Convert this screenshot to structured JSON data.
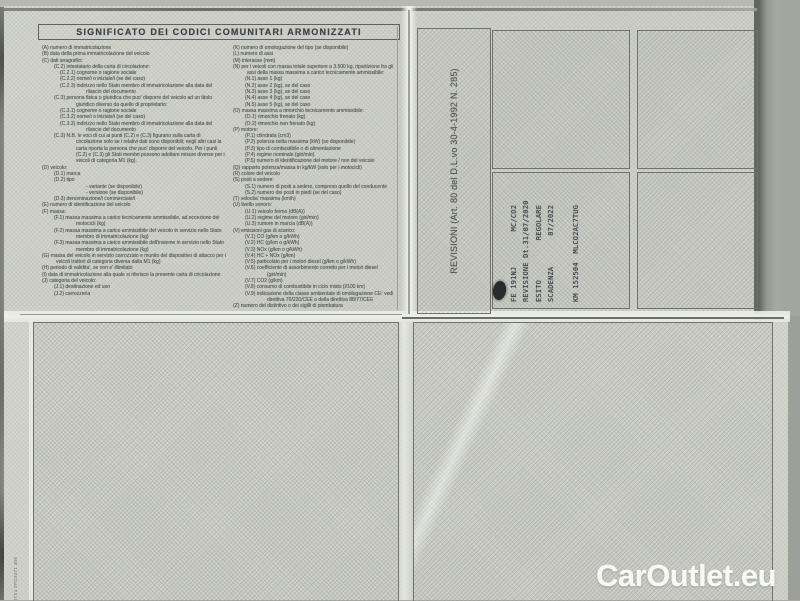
{
  "page": {
    "title": "SIGNIFICATO DEI CODICI COMUNITARI ARMONIZZATI",
    "side_serial": "ITIIu 3PO3471 408",
    "watermark": "CarOutlet.eu"
  },
  "colors": {
    "paper": "#d2d4cd",
    "hatch": "#aeb2a8",
    "legend_ink": "#565b57",
    "stamp_ink": "#3e4149",
    "watermark_text": "#fdfefd"
  },
  "codes": {
    "left_column": [
      {
        "l": 0,
        "t": "(A)  numero di immatricolazione"
      },
      {
        "l": 0,
        "t": "(B)  data della prima immatricolazione del veicolo"
      },
      {
        "l": 0,
        "t": "(C)  dati anagrafici:"
      },
      {
        "l": 1,
        "t": "(C.2)  intestatario della carta di circolazione:"
      },
      {
        "l": 2,
        "t": "(C.2.1)  cognome o ragione sociale"
      },
      {
        "l": 2,
        "t": "(C.2.2)  nome/i o iniziale/i (se del caso)"
      },
      {
        "l": 2,
        "t": "(C.2.3)  indirizzo nello Stato membro di immatricolazione alla data del rilascio del documento"
      },
      {
        "l": 1,
        "t": "(C.3)  persona fisica o giuridica che puo' disporre del veicolo ad un titolo giuridico diverso da quello di proprietario:"
      },
      {
        "l": 2,
        "t": "(C.3.1)  cognome o ragione sociale"
      },
      {
        "l": 2,
        "t": "(C.3.2)  nome/i o iniziale/i (se del caso)"
      },
      {
        "l": 2,
        "t": "(C.3.3)  indirizzo nello Stato membro di immatricolazione alla data del rilascio del documento"
      },
      {
        "l": 1,
        "t": "(C.3)  N.B. le voci di cui ai punti (C.2) e (C.3) figurano sulla carta di circolazione solo se i relativi dati sono disponibili; negli altri casi la carta riporta la persona che puo' disporre del veicolo. Per i punti (C.2) e (C.3) gli Stati membri possono adottare misure diverse per i veicoli di categoria M1 (kg)."
      },
      {
        "l": 0,
        "t": "(D)  veicolo:"
      },
      {
        "l": 1,
        "t": "(D.1)  marca"
      },
      {
        "l": 1,
        "t": "(D.2)  tipo"
      },
      {
        "l": 3,
        "t": "-  variante (se disponibile)"
      },
      {
        "l": 3,
        "t": "-  versione (se disponibile)"
      },
      {
        "l": 1,
        "t": "(D.3)  denominazione/i commerciale/i"
      },
      {
        "l": 0,
        "t": "(E)  numero di identificazione del veicolo"
      },
      {
        "l": 0,
        "t": "(F)  massa:"
      },
      {
        "l": 1,
        "t": "(F.1)  massa massima a carico tecnicamente ammissibile, ad eccezione dei motocicli (kg)"
      },
      {
        "l": 1,
        "t": "(F.2)  massa massima a carico ammissibile del veicolo in servizio nello Stato membro di immatricolazione (kg)"
      },
      {
        "l": 1,
        "t": "(F.3)  massa massima a carico ammissibile dell'insieme in servizio nello Stato membro di immatricolazione (kg)"
      },
      {
        "l": 0,
        "t": "(G)  massa del veicolo in servizio carrozzato e munito del dispositivo di attacco per i veicoli trattori di categoria diversa dalla M1 (kg)"
      },
      {
        "l": 0,
        "t": "(H)  periodo di validita', se non e' illimitato"
      },
      {
        "l": 0,
        "t": "(I)  data di immatricolazione alla quale si riferisce la presente carta di circolazione"
      },
      {
        "l": 0,
        "t": "(J)  categoria del veicolo:"
      },
      {
        "l": 1,
        "t": "(J.1)  destinazione ed uso"
      },
      {
        "l": 1,
        "t": "(J.2)  carrozzeria"
      }
    ],
    "right_column": [
      {
        "l": 0,
        "t": "(K)  numero di omologazione del tipo (se disponibile)"
      },
      {
        "l": 0,
        "t": "(L)  numero di assi"
      },
      {
        "l": 0,
        "t": "(M)  interasse (mm)"
      },
      {
        "l": 0,
        "t": "(N)  per i veicoli con massa totale superiore a 3.500 kg, ripartizione fra gli assi della massa massima a carico tecnicamente ammissibile:"
      },
      {
        "l": 1,
        "t": "(N.1)  asse 1 (kg)"
      },
      {
        "l": 1,
        "t": "(N.2)  asse 2 (kg), se del caso"
      },
      {
        "l": 1,
        "t": "(N.3)  asse 3 (kg), se del caso"
      },
      {
        "l": 1,
        "t": "(N.4)  asse 4 (kg), se del caso"
      },
      {
        "l": 1,
        "t": "(N.5)  asse 5 (kg), se del caso"
      },
      {
        "l": 0,
        "t": "(O)  massa massima a rimorchio tecnicamente ammissibile:"
      },
      {
        "l": 1,
        "t": "(O.1)  rimorchio frenato (kg)"
      },
      {
        "l": 1,
        "t": "(O.2)  rimorchio non frenato (kg)"
      },
      {
        "l": 0,
        "t": "(P)  motore:"
      },
      {
        "l": 1,
        "t": "(P.1)  cilindrata (cm3)"
      },
      {
        "l": 1,
        "t": "(P.2)  potenza netta massima (kW) (se disponibile)"
      },
      {
        "l": 1,
        "t": "(P.3)  tipo di combustibile o di alimentazione"
      },
      {
        "l": 1,
        "t": "(P.4)  regime nominale (giri/min)"
      },
      {
        "l": 1,
        "t": "(P.5)  numero di identificazione del motore / non del veicolo"
      },
      {
        "l": 0,
        "t": "(Q)  rapporto potenza/massa in kg/kW (solo per i motocicli)"
      },
      {
        "l": 0,
        "t": "(R)  colore del veicolo"
      },
      {
        "l": 0,
        "t": "(S)  posti a sedere:"
      },
      {
        "l": 1,
        "t": "(S.1)  numero di posti a sedere, compreso quello del conducente"
      },
      {
        "l": 1,
        "t": "(S.2)  numero dei posti in piedi (se del caso)"
      },
      {
        "l": 0,
        "t": "(T)  velocita' massima (km/h)"
      },
      {
        "l": 0,
        "t": "(U)  livello sonoro:"
      },
      {
        "l": 1,
        "t": "(U.1)  veicolo fermo (dB(A))"
      },
      {
        "l": 1,
        "t": "(U.2)  regime del motore (giri/min)"
      },
      {
        "l": 1,
        "t": "(U.3)  rumore in marcia (dB(A))"
      },
      {
        "l": 0,
        "t": "(V)  emissioni gas di scarico:"
      },
      {
        "l": 1,
        "t": "(V.1)  CO (g/km o g/kWh)"
      },
      {
        "l": 1,
        "t": "(V.2)  HC (g/km o g/kWh)"
      },
      {
        "l": 1,
        "t": "(V.3)  NOx (g/km o g/kWh)"
      },
      {
        "l": 1,
        "t": "(V.4)  HC + NOx (g/km)"
      },
      {
        "l": 1,
        "t": "(V.5)  particolato per i motori diesel (g/km o g/kWh)"
      },
      {
        "l": 1,
        "t": "(V.6)  coefficiente di assorbimento corretto per i motori diesel (giri/min)"
      },
      {
        "l": 1,
        "t": "(V.7)  CO2 (g/km)"
      },
      {
        "l": 1,
        "t": "(V.8)  consumo di combustibile in ciclo misto (l/100 km)"
      },
      {
        "l": 1,
        "t": "(V.9)  indicazione della classe ambientale di omologazione CE: vedi direttiva 70/220/CEE o della direttiva 88/77/CEE"
      },
      {
        "l": 0,
        "t": "(Z)  numero del distintivo o dei sigilli di piombatura"
      }
    ]
  },
  "revisioni": {
    "label": "REVISIONI (Art. 80 del D.L.vo 30-4-1992 N. 285)",
    "stamp_lines": [
      "FE 191NJ        MC/CO2",
      "REVISIONE Dt.31/07/2020",
      "ESITO         REGOLARE",
      "SCADENZA       07/2022",
      "",
      "KM 152504  MLCO2AC7TUG"
    ]
  }
}
